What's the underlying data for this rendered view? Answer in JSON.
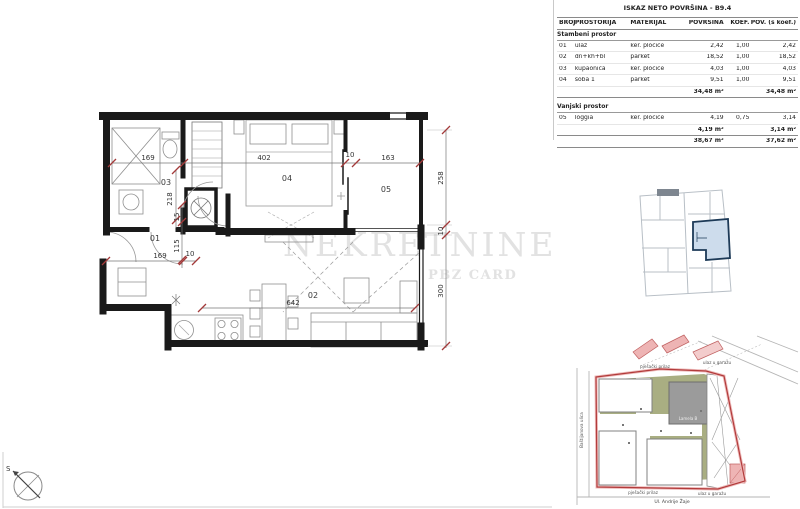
{
  "table": {
    "title": "ISKAZ NETO POVRŠINA - B9.4",
    "columns": {
      "broj": "BROJ",
      "prostorija": "PROSTORIJA",
      "materijal": "MATERIJAL",
      "povrsina": "POVRŠINA",
      "koef": "KOEF.",
      "pov_koef": "POV. (s koef.)"
    },
    "sections": [
      {
        "name": "Stambeni prostor",
        "rows": [
          {
            "num": "01",
            "name": "ulaz",
            "material": "ker. pločice",
            "area": "2,42",
            "koef": "1,00",
            "area_koef": "2,42"
          },
          {
            "num": "02",
            "name": "dn+kh+bl",
            "material": "parket",
            "area": "18,52",
            "koef": "1,00",
            "area_koef": "18,52"
          },
          {
            "num": "03",
            "name": "kupaonica",
            "material": "ker. pločice",
            "area": "4,03",
            "koef": "1,00",
            "area_koef": "4,03"
          },
          {
            "num": "04",
            "name": "soba 1",
            "material": "parket",
            "area": "9,51",
            "koef": "1,00",
            "area_koef": "9,51"
          }
        ],
        "subtotal_area": "34,48 m²",
        "subtotal_area_koef": "34,48 m²"
      },
      {
        "name": "Vanjski prostor",
        "rows": [
          {
            "num": "05",
            "name": "loggia",
            "material": "ker. pločice",
            "area": "4,19",
            "koef": "0,75",
            "area_koef": "3,14"
          }
        ],
        "subtotal_area": "4,19 m²",
        "subtotal_area_koef": "3,14 m²"
      }
    ],
    "total_area": "38,67 m²",
    "total_area_koef": "37,62 m²"
  },
  "plan": {
    "rooms": {
      "r1": "01",
      "r2": "02",
      "r3": "03",
      "r4": "04",
      "r5": "05"
    },
    "dims": {
      "top_1": "169",
      "top_2": "402",
      "top_3": "10",
      "top_4": "163",
      "left_1": "218",
      "left_2": "15",
      "left_3": "115",
      "bottom_1": "169",
      "bottom_2": "10",
      "living": "642",
      "right_1": "258",
      "right_2": "10",
      "right_3": "300"
    },
    "north_label": "S"
  },
  "watermark": {
    "line1": "NEKRETNINE",
    "line2": "PBZ CARD"
  },
  "siteplan": {
    "building": "Lamela B",
    "access_top": "pješački prilaz",
    "garage_top": "ulaz u garažu",
    "access_bottom": "pješački prilaz",
    "garage_bottom": "ulaz u garažu",
    "street_bottom": "Ul. Andrije Žaje",
    "street_left": "Baštijanova ulica"
  },
  "colors": {
    "wall": "#1a1a1a",
    "dim_tick": "#a33a3a",
    "watermark": "#e2e2e2",
    "highlight_fill": "#cddcec",
    "highlight_stroke": "#1d3a57",
    "site_boundary": "#b23b3b",
    "site_green": "#a9ae82",
    "site_pink": "#eeb4b4"
  }
}
